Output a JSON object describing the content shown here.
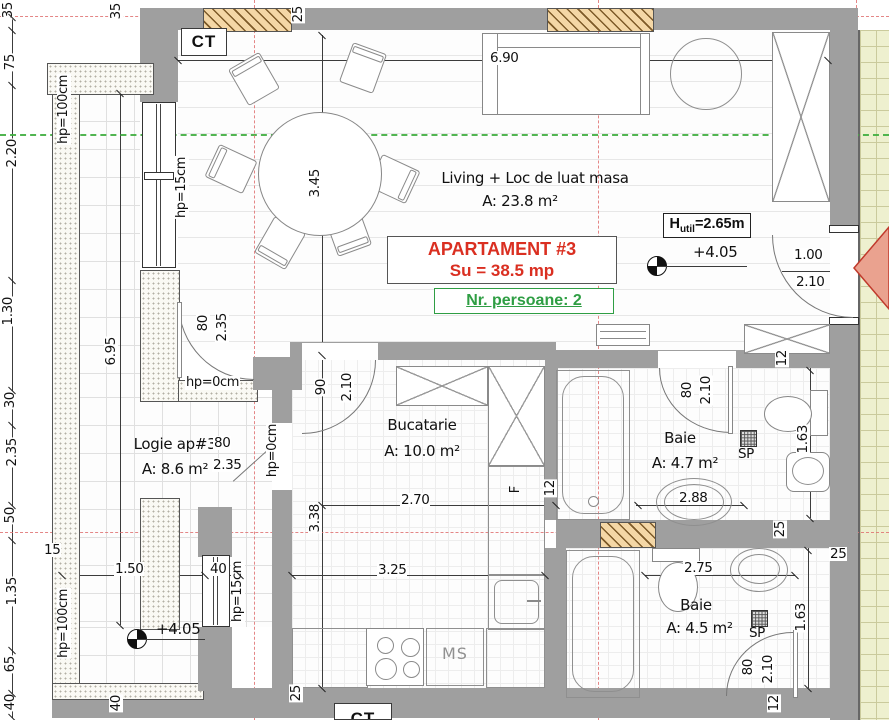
{
  "meta": {
    "drawing": "apartment floor plan",
    "width_px": 889,
    "height_px": 720
  },
  "colors": {
    "title_red": "#da2f21",
    "persons_green": "#2f9e44",
    "centerline_red": "#e07272",
    "axis_green": "#3fae3f",
    "wall_gray": "#9f9f9f",
    "hatch_tan": "#f4d7a6",
    "corridor_yellow": "#eef0cf"
  },
  "boxes": {
    "ct_top": "CT",
    "ct_bottom": "CT",
    "title1": "APARTAMENT #3",
    "title2": "Su = 38.5 mp",
    "persons": "Nr. persoane: 2",
    "h_util_prefix": "H",
    "h_util_sub": "util",
    "h_util_rest": "=2.65m"
  },
  "rooms": [
    {
      "name": "Living + Loc de luat masa",
      "area": "A: 23.8 m²"
    },
    {
      "name": "Bucatarie",
      "area": "A: 10.0 m²"
    },
    {
      "name": "Baie",
      "area": "A: 4.7 m²"
    },
    {
      "name": "Baie",
      "area": "A: 4.5 m²"
    },
    {
      "name": "Logie ap#3",
      "area": "A: 8.6 m²"
    }
  ],
  "levels": [
    "+4.05",
    "+4.05"
  ],
  "appliances": {
    "fridge": "F",
    "washer": "MS",
    "drain1": "SP",
    "drain2": "SP"
  },
  "labels": [
    {
      "t": "6.90",
      "x": 489,
      "y": 51,
      "n": "dim-6-90"
    },
    {
      "t": "3.45",
      "x": 308,
      "y": 168,
      "r": 1,
      "n": "dim-3-45"
    },
    {
      "t": "6.95",
      "x": 104,
      "y": 336,
      "r": 1,
      "n": "dim-6-95"
    },
    {
      "t": "2.70",
      "x": 400,
      "y": 493,
      "n": "dim-2-70"
    },
    {
      "t": "3.38",
      "x": 308,
      "y": 503,
      "r": 1,
      "n": "dim-3-38"
    },
    {
      "t": "3.25",
      "x": 377,
      "y": 563,
      "n": "dim-3-25"
    },
    {
      "t": "2.88",
      "x": 678,
      "y": 491,
      "n": "dim-2-88"
    },
    {
      "t": "2.75",
      "x": 683,
      "y": 561,
      "n": "dim-2-75"
    },
    {
      "t": "1.63",
      "x": 796,
      "y": 424,
      "r": 1,
      "n": "dim-1-63-a"
    },
    {
      "t": "1.63",
      "x": 794,
      "y": 602,
      "r": 1,
      "n": "dim-1-63-b"
    },
    {
      "t": "1.50",
      "x": 114,
      "y": 562,
      "n": "dim-1-50"
    },
    {
      "t": "15",
      "x": 43,
      "y": 543,
      "n": "dim-15"
    },
    {
      "t": "40",
      "x": 209,
      "y": 562,
      "n": "dim-40-a"
    },
    {
      "t": "40",
      "x": 109,
      "y": 694,
      "r": 1,
      "n": "dim-40-b"
    },
    {
      "t": "25",
      "x": 291,
      "y": 5,
      "r": 1,
      "n": "dim-25-top"
    },
    {
      "t": "25",
      "x": 289,
      "y": 684,
      "r": 1,
      "n": "dim-25-bottom"
    },
    {
      "t": "25",
      "x": 773,
      "y": 520,
      "r": 1,
      "n": "dim-25-mid"
    },
    {
      "t": "25",
      "x": 829,
      "y": 547,
      "n": "dim-25-right"
    },
    {
      "t": "35",
      "x": 109,
      "y": 2,
      "r": 1,
      "n": "dim-35-top"
    },
    {
      "t": "12",
      "x": 543,
      "y": 479,
      "r": 1,
      "n": "dim-12-kitchen"
    },
    {
      "t": "12",
      "x": 775,
      "y": 349,
      "r": 1,
      "n": "dim-12-bath1"
    },
    {
      "t": "12",
      "x": 767,
      "y": 694,
      "r": 1,
      "n": "dim-12-bath2"
    },
    {
      "t": "35",
      "x": 1,
      "y": 1,
      "r": 1,
      "n": "chain-35"
    },
    {
      "t": "75",
      "x": 3,
      "y": 53,
      "r": 1,
      "n": "chain-75"
    },
    {
      "t": "2.20",
      "x": 5,
      "y": 138,
      "r": 1,
      "n": "chain-2-20"
    },
    {
      "t": "1.30",
      "x": 1,
      "y": 296,
      "r": 1,
      "n": "chain-1-30"
    },
    {
      "t": "30",
      "x": 3,
      "y": 391,
      "r": 1,
      "n": "chain-30"
    },
    {
      "t": "2.35",
      "x": 5,
      "y": 437,
      "r": 1,
      "n": "chain-2-35"
    },
    {
      "t": "50",
      "x": 3,
      "y": 506,
      "r": 1,
      "n": "chain-50"
    },
    {
      "t": "1.35",
      "x": 5,
      "y": 576,
      "r": 1,
      "n": "chain-1-35"
    },
    {
      "t": "65",
      "x": 3,
      "y": 655,
      "r": 1,
      "n": "chain-65"
    },
    {
      "t": "40",
      "x": 3,
      "y": 693,
      "r": 1,
      "n": "chain-40"
    },
    {
      "t": "80",
      "x": 196,
      "y": 314,
      "r": 1,
      "n": "door-logie-width"
    },
    {
      "t": "2.35",
      "x": 215,
      "y": 312,
      "r": 1,
      "n": "door-logie-height"
    },
    {
      "t": "80",
      "x": 213,
      "y": 436,
      "n": "door-logie2-width"
    },
    {
      "t": "2.35",
      "x": 212,
      "y": 458,
      "n": "door-logie2-height"
    },
    {
      "t": "90",
      "x": 314,
      "y": 378,
      "r": 1,
      "n": "door-kitchen-width"
    },
    {
      "t": "2.10",
      "x": 340,
      "y": 372,
      "r": 1,
      "n": "door-kitchen-height"
    },
    {
      "t": "80",
      "x": 680,
      "y": 381,
      "r": 1,
      "n": "door-bath1-width"
    },
    {
      "t": "2.10",
      "x": 699,
      "y": 375,
      "r": 1,
      "n": "door-bath1-height"
    },
    {
      "t": "80",
      "x": 741,
      "y": 658,
      "r": 1,
      "n": "door-bath2-width"
    },
    {
      "t": "2.10",
      "x": 761,
      "y": 654,
      "r": 1,
      "n": "door-bath2-height"
    },
    {
      "t": "1.00",
      "x": 793,
      "y": 248,
      "n": "door-entry-width"
    },
    {
      "t": "2.10",
      "x": 795,
      "y": 275,
      "n": "door-entry-height"
    },
    {
      "t": "hp=100cm",
      "x": 57,
      "y": 74,
      "r": 1,
      "c": "hp",
      "n": "parapet-100-top"
    },
    {
      "t": "hp=100cm",
      "x": 57,
      "y": 588,
      "r": 1,
      "c": "hp",
      "n": "parapet-100-bottom"
    },
    {
      "t": "hp=15cm",
      "x": 175,
      "y": 156,
      "r": 1,
      "c": "hp",
      "n": "parapet-15-living"
    },
    {
      "t": "hp=15cm",
      "x": 231,
      "y": 560,
      "r": 1,
      "c": "hp",
      "n": "parapet-15-logie"
    },
    {
      "t": "hp=0cm",
      "x": 185,
      "y": 376,
      "c": "hp",
      "n": "parapet-0-door"
    },
    {
      "t": "hp=0cm",
      "x": 266,
      "y": 423,
      "r": 1,
      "c": "hp",
      "n": "parapet-0-door2"
    }
  ]
}
